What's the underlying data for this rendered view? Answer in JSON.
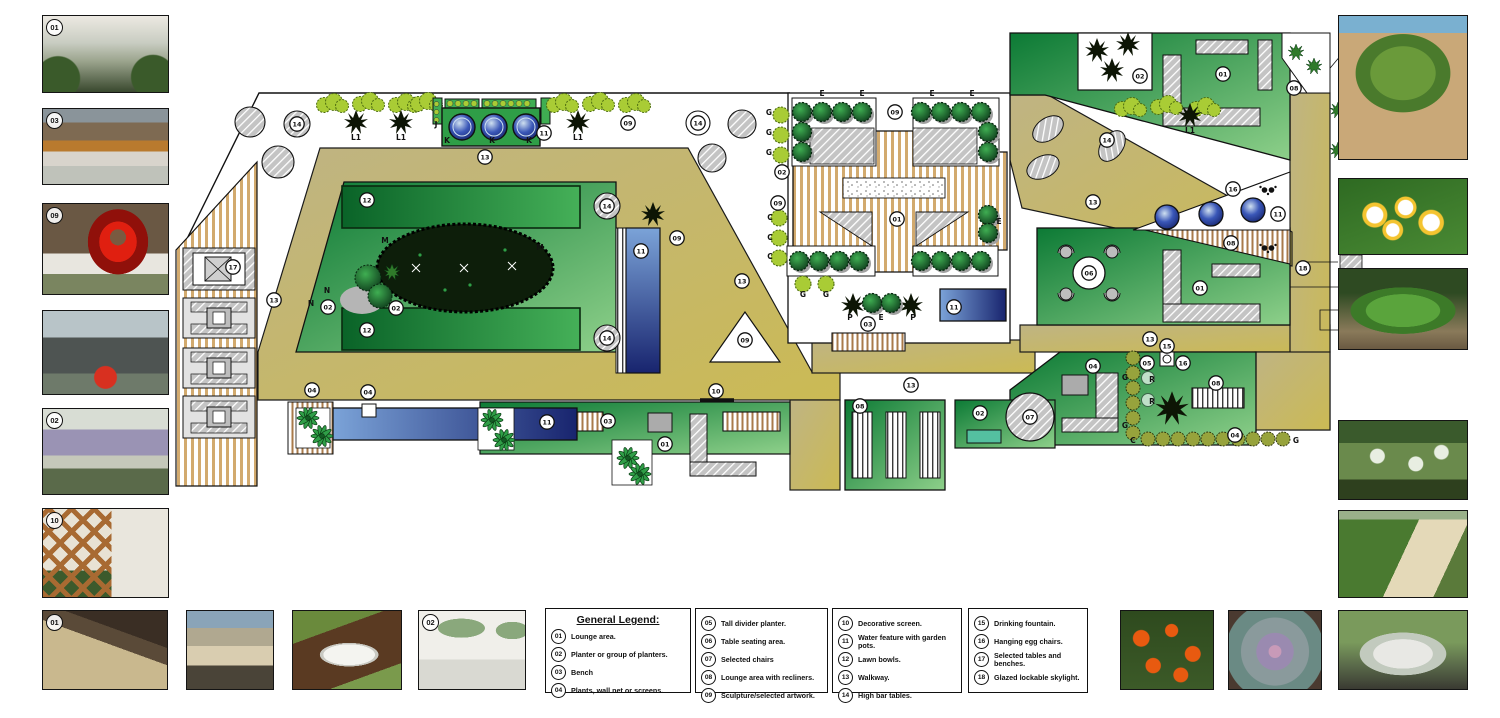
{
  "legend": {
    "title": "General Legend:",
    "groups": [
      {
        "items": [
          {
            "num": "01",
            "label": "Lounge area."
          },
          {
            "num": "02",
            "label": "Planter or group of planters."
          },
          {
            "num": "03",
            "label": "Bench"
          },
          {
            "num": "04",
            "label": "Plants, wall net or screens."
          }
        ]
      },
      {
        "items": [
          {
            "num": "05",
            "label": "Tall divider planter."
          },
          {
            "num": "06",
            "label": "Table seating area."
          },
          {
            "num": "07",
            "label": "Selected chairs"
          },
          {
            "num": "08",
            "label": "Lounge area with recliners."
          },
          {
            "num": "09",
            "label": "Sculpture/selected artwork."
          }
        ]
      },
      {
        "items": [
          {
            "num": "10",
            "label": "Decorative screen."
          },
          {
            "num": "11",
            "label": "Water feature with garden pots."
          },
          {
            "num": "12",
            "label": "Lawn bowls."
          },
          {
            "num": "13",
            "label": "Walkway."
          },
          {
            "num": "14",
            "label": "High bar tables."
          }
        ]
      },
      {
        "items": [
          {
            "num": "15",
            "label": "Drinking fountain."
          },
          {
            "num": "16",
            "label": "Hanging egg chairs."
          },
          {
            "num": "17",
            "label": "Selected tables and benches."
          },
          {
            "num": "18",
            "label": "Glazed lockable skylight."
          }
        ]
      }
    ]
  },
  "plan": {
    "markers": [
      {
        "n": "17",
        "x": 233,
        "y": 267
      },
      {
        "n": "14",
        "x": 297,
        "y": 124
      },
      {
        "n": "13",
        "x": 274,
        "y": 300
      },
      {
        "n": "13",
        "x": 485,
        "y": 157
      },
      {
        "n": "12",
        "x": 367,
        "y": 200
      },
      {
        "n": "12",
        "x": 367,
        "y": 330
      },
      {
        "n": "02",
        "x": 328,
        "y": 307
      },
      {
        "n": "02",
        "x": 396,
        "y": 308
      },
      {
        "n": "14",
        "x": 607,
        "y": 206
      },
      {
        "n": "14",
        "x": 607,
        "y": 338
      },
      {
        "n": "09",
        "x": 677,
        "y": 238
      },
      {
        "n": "11",
        "x": 641,
        "y": 251
      },
      {
        "n": "11",
        "x": 544,
        "y": 133
      },
      {
        "n": "09",
        "x": 628,
        "y": 123
      },
      {
        "n": "14",
        "x": 698,
        "y": 123
      },
      {
        "n": "09",
        "x": 895,
        "y": 112
      },
      {
        "n": "01",
        "x": 897,
        "y": 219
      },
      {
        "n": "02",
        "x": 782,
        "y": 172
      },
      {
        "n": "09",
        "x": 778,
        "y": 203
      },
      {
        "n": "13",
        "x": 742,
        "y": 281
      },
      {
        "n": "09",
        "x": 745,
        "y": 340
      },
      {
        "n": "10",
        "x": 716,
        "y": 391
      },
      {
        "n": "03",
        "x": 868,
        "y": 324
      },
      {
        "n": "11",
        "x": 954,
        "y": 307
      },
      {
        "n": "02",
        "x": 1140,
        "y": 76
      },
      {
        "n": "01",
        "x": 1223,
        "y": 74
      },
      {
        "n": "08",
        "x": 1294,
        "y": 88
      },
      {
        "n": "14",
        "x": 1107,
        "y": 140
      },
      {
        "n": "13",
        "x": 1093,
        "y": 202
      },
      {
        "n": "16",
        "x": 1233,
        "y": 189
      },
      {
        "n": "11",
        "x": 1278,
        "y": 214
      },
      {
        "n": "08",
        "x": 1231,
        "y": 243
      },
      {
        "n": "06",
        "x": 1089,
        "y": 273
      },
      {
        "n": "01",
        "x": 1200,
        "y": 288
      },
      {
        "n": "18",
        "x": 1303,
        "y": 268
      },
      {
        "n": "13",
        "x": 1150,
        "y": 339
      },
      {
        "n": "04",
        "x": 1093,
        "y": 366
      },
      {
        "n": "05",
        "x": 1147,
        "y": 363
      },
      {
        "n": "16",
        "x": 1183,
        "y": 363
      },
      {
        "n": "08",
        "x": 1216,
        "y": 383
      },
      {
        "n": "04",
        "x": 1235,
        "y": 435
      },
      {
        "n": "07",
        "x": 1030,
        "y": 417
      },
      {
        "n": "02",
        "x": 980,
        "y": 413
      },
      {
        "n": "08",
        "x": 860,
        "y": 406
      },
      {
        "n": "13",
        "x": 911,
        "y": 385
      },
      {
        "n": "11",
        "x": 547,
        "y": 422
      },
      {
        "n": "03",
        "x": 608,
        "y": 421
      },
      {
        "n": "01",
        "x": 665,
        "y": 444
      },
      {
        "n": "04",
        "x": 312,
        "y": 390
      },
      {
        "n": "04",
        "x": 368,
        "y": 392
      },
      {
        "n": "15",
        "x": 1167,
        "y": 346
      }
    ],
    "letters": [
      {
        "t": "L1",
        "x": 356,
        "y": 140
      },
      {
        "t": "L1",
        "x": 401,
        "y": 140
      },
      {
        "t": "L1",
        "x": 578,
        "y": 140
      },
      {
        "t": "L1",
        "x": 1190,
        "y": 133
      },
      {
        "t": "M",
        "x": 385,
        "y": 243
      },
      {
        "t": "M",
        "x": 540,
        "y": 250
      },
      {
        "t": "N",
        "x": 327,
        "y": 293
      },
      {
        "t": "N",
        "x": 311,
        "y": 306
      },
      {
        "t": "E",
        "x": 822,
        "y": 96
      },
      {
        "t": "E",
        "x": 862,
        "y": 96
      },
      {
        "t": "E",
        "x": 932,
        "y": 96
      },
      {
        "t": "E",
        "x": 972,
        "y": 96
      },
      {
        "t": "E",
        "x": 999,
        "y": 224
      },
      {
        "t": "P",
        "x": 850,
        "y": 320
      },
      {
        "t": "E",
        "x": 881,
        "y": 320
      },
      {
        "t": "P",
        "x": 913,
        "y": 320
      },
      {
        "t": "C",
        "x": 770,
        "y": 220
      },
      {
        "t": "C",
        "x": 770,
        "y": 240
      },
      {
        "t": "C",
        "x": 770,
        "y": 259
      },
      {
        "t": "G",
        "x": 769,
        "y": 115
      },
      {
        "t": "G",
        "x": 769,
        "y": 135
      },
      {
        "t": "G",
        "x": 769,
        "y": 155
      },
      {
        "t": "G",
        "x": 803,
        "y": 297
      },
      {
        "t": "G",
        "x": 826,
        "y": 297
      },
      {
        "t": "J",
        "x": 436,
        "y": 127
      },
      {
        "t": "K",
        "x": 447,
        "y": 143
      },
      {
        "t": "K",
        "x": 492,
        "y": 143
      },
      {
        "t": "K",
        "x": 529,
        "y": 143
      },
      {
        "t": "R",
        "x": 1152,
        "y": 382
      },
      {
        "t": "R",
        "x": 1152,
        "y": 404
      },
      {
        "t": "G",
        "x": 1125,
        "y": 380
      },
      {
        "t": "G",
        "x": 1125,
        "y": 428
      },
      {
        "t": "C",
        "x": 1133,
        "y": 443
      },
      {
        "t": "G",
        "x": 1296,
        "y": 443
      }
    ],
    "colors": {
      "walkway": "#CBBA63",
      "lawn_dark": "#0C7A35",
      "lawn_light": "#8ED08A",
      "water_dark": "#18246E",
      "water_light": "#7BA3D8",
      "hedge": "#A9CC35",
      "hatch_gray": "#C4C4C4",
      "deck_stripe": "#D2AA6E"
    }
  },
  "photos": {
    "left": [
      {
        "subject": "courtyard-lounge-area",
        "badge": "01"
      },
      {
        "subject": "timber-bench",
        "badge": "03"
      },
      {
        "subject": "red-sculpture",
        "badge": "09"
      },
      {
        "subject": "planter-group-red-bowl",
        "badge": ""
      },
      {
        "subject": "lavender-planters",
        "badge": "02"
      },
      {
        "subject": "decorative-screen-with-bowl",
        "badge": "10"
      }
    ],
    "right": [
      {
        "subject": "golden-cane-palm",
        "badge": ""
      },
      {
        "subject": "frangipani-flowers",
        "badge": ""
      },
      {
        "subject": "green-shrub-mound",
        "badge": ""
      },
      {
        "subject": "white-flowering-groundcover",
        "badge": ""
      },
      {
        "subject": "hedge-beside-path",
        "badge": ""
      }
    ],
    "bottom": [
      {
        "subject": "deck-water-feature",
        "badge": "01"
      },
      {
        "subject": "sun-loungers",
        "badge": ""
      },
      {
        "subject": "water-bowl",
        "badge": ""
      },
      {
        "subject": "white-planters",
        "badge": "02"
      },
      {
        "subject": "orange-flowers",
        "badge": ""
      },
      {
        "subject": "succulent-rosette",
        "badge": ""
      },
      {
        "subject": "silver-mound-plant",
        "badge": ""
      }
    ]
  }
}
